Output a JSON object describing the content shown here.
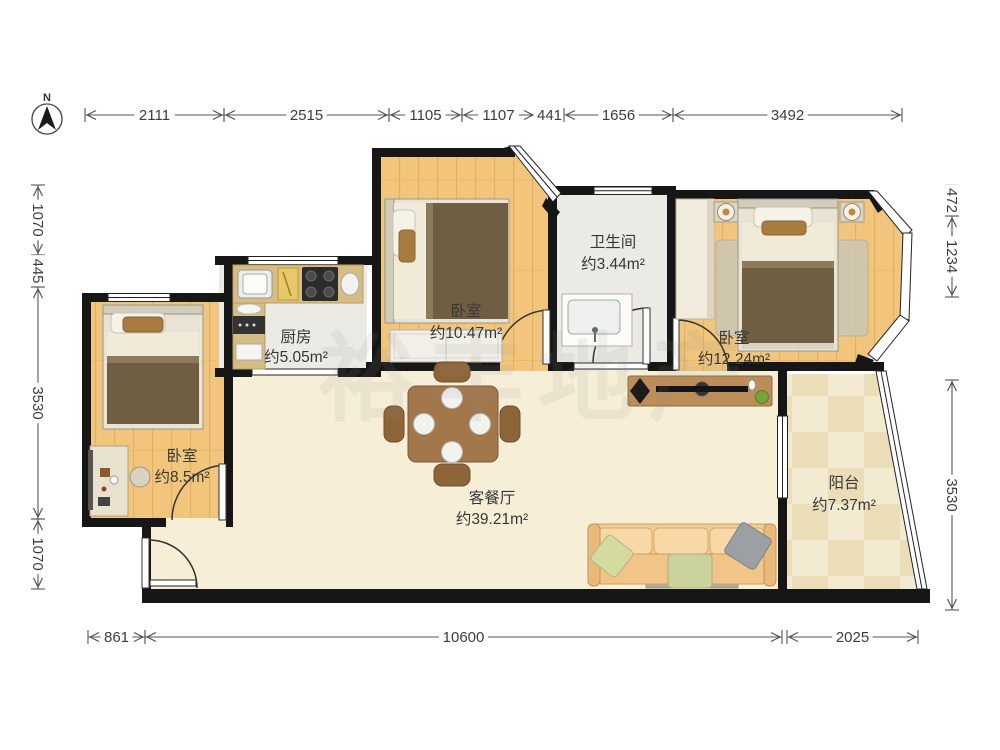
{
  "compass": {
    "label": "N"
  },
  "dimensions": {
    "top": [
      "2111",
      "2515",
      "1105",
      "1107",
      "441",
      "1656",
      "3492"
    ],
    "bottom": [
      "861",
      "10600",
      "2025"
    ],
    "left": [
      "1070",
      "445",
      "3530",
      "1070"
    ],
    "right": [
      "472",
      "1234",
      "3530"
    ]
  },
  "rooms": [
    {
      "name": "厨房",
      "area": "约5.05m²"
    },
    {
      "name": "卧室",
      "area": "约10.47m²"
    },
    {
      "name": "卫生间",
      "area": "约3.44m²"
    },
    {
      "name": "卧室",
      "area": "约12.24m²"
    },
    {
      "name": "卧室",
      "area": "约8.5m²"
    },
    {
      "name": "客餐厅",
      "area": "约39.21m²"
    },
    {
      "name": "阳台",
      "area": "约7.37m²"
    }
  ],
  "watermark": "裕丰地产",
  "colors": {
    "wall": "#161616",
    "wood_floor": "#f1c67c",
    "living_floor": "#f6eed6",
    "tile_light": "#f2ead1",
    "tile_dark": "#eaddb8",
    "wet_floor": "#ebeae5",
    "furniture_brown": "#a2774b",
    "blanket_brown": "#705e43"
  }
}
